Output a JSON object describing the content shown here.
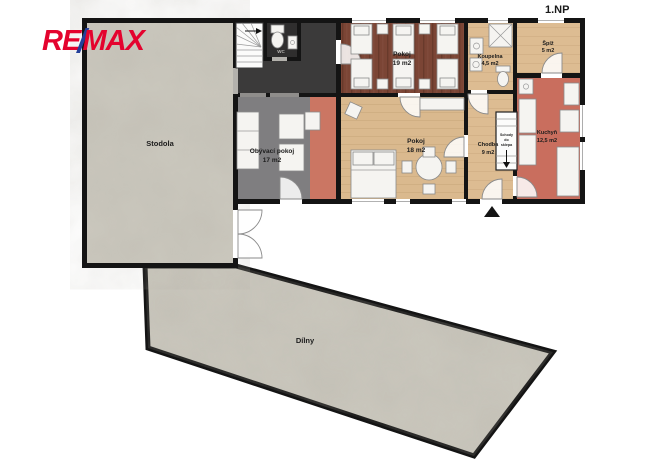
{
  "page": {
    "floor_label": "1.NP"
  },
  "logo": {
    "re": "RE",
    "slash": "/",
    "max": "MAX",
    "red": "#e4032e",
    "blue": "#24409a"
  },
  "rooms": [
    {
      "id": "stodola",
      "name": "Stodola",
      "area": ""
    },
    {
      "id": "obyvaci-pokoj",
      "name": "Obývací pokoj",
      "area": "17 m2"
    },
    {
      "id": "pokoj-19",
      "name": "Pokoj",
      "area": "19 m2"
    },
    {
      "id": "pokoj-18",
      "name": "Pokoj",
      "area": "18 m2"
    },
    {
      "id": "koupelna",
      "name": "Koupelna",
      "area": "4,5 m2"
    },
    {
      "id": "spiz",
      "name": "Špíž",
      "area": "5 m2"
    },
    {
      "id": "chodba",
      "name": "Chodba",
      "area": "9 m2"
    },
    {
      "id": "kuchyn",
      "name": "Kuchyň",
      "area": "12,5 m2"
    },
    {
      "id": "dilny",
      "name": "Dílny",
      "area": ""
    },
    {
      "id": "wc",
      "name": "WC",
      "area": ""
    }
  ],
  "annotations": {
    "basement_stairs_line1": "Schody",
    "basement_stairs_line2": "do",
    "basement_stairs_line3": "sklepa"
  },
  "colors": {
    "wall": "#141414",
    "barn_floor": "#cbc8be",
    "hall_floor": "#3b3a3a",
    "living_floor": "#7f7e80",
    "accent_strip": "#cb7663",
    "bedroom19_floor": "#7b4535",
    "bedroom18_floor": "#dab98e",
    "kitchen_floor": "#c96e5e",
    "tan_floor": "#dcba90",
    "logo_red": "#e4032e",
    "logo_blue": "#24409a"
  }
}
